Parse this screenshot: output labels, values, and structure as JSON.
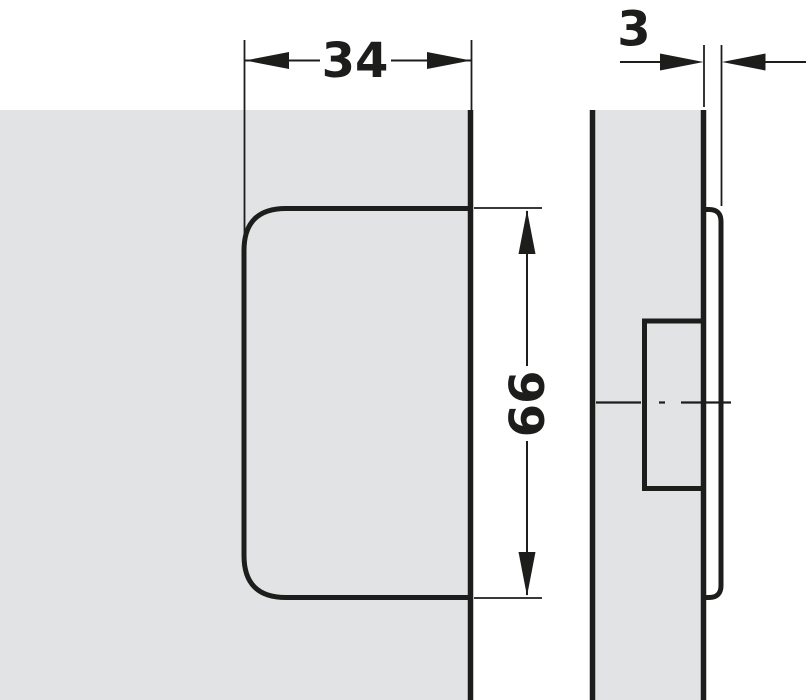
{
  "drawing": {
    "kind": "technical-dimension-drawing",
    "views": {
      "front": "fitting front view on panel edge",
      "side": "fitting side view on panel section"
    }
  },
  "dimensions": {
    "width": "34",
    "height": "66",
    "thickness": "3"
  },
  "colors": {
    "panel_fill": "#e2e3e4",
    "fitting_fill": "#ffffff",
    "line": "#1d1d1b"
  }
}
